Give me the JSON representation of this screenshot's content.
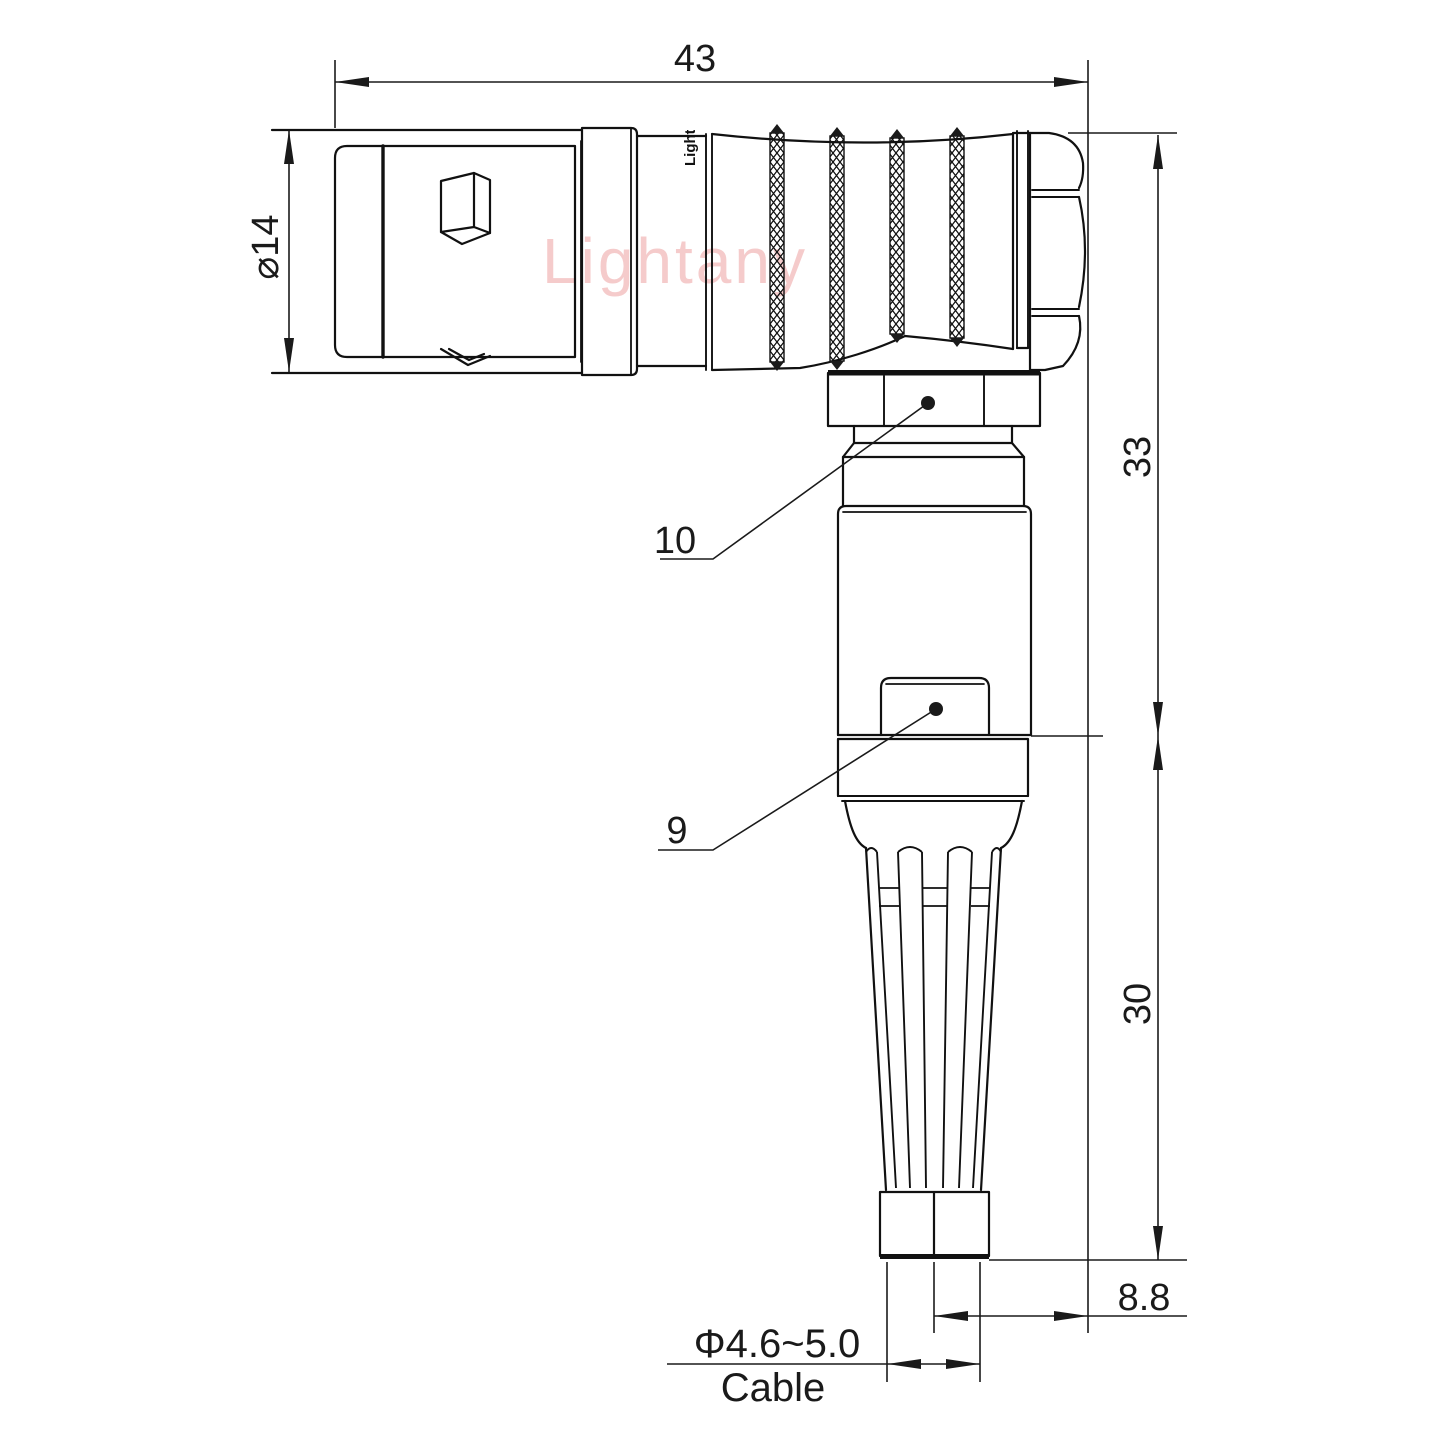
{
  "drawing": {
    "watermark": "Lightany",
    "brand_mark": "Lightany",
    "dimensions": {
      "overall_length": "43",
      "front_diameter": "⌀14",
      "upper_height": "33",
      "lower_height": "30",
      "axis_offset": "8.8",
      "cable_diameter": "Φ4.6~5.0",
      "cable_label": "Cable"
    },
    "callouts": {
      "nut_label": "10",
      "latch_label": "9"
    },
    "colors": {
      "line": "#111111",
      "dimension": "#1a1a1a",
      "watermark_pink": "#f4c6c6",
      "background": "#ffffff"
    }
  }
}
